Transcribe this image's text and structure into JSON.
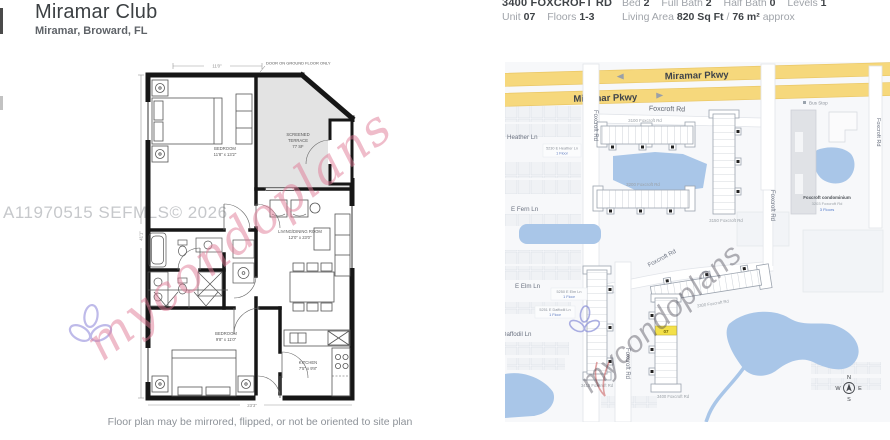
{
  "header": {
    "title": "Miramar Club",
    "subtitle": "Miramar, Broward, FL",
    "address": "3400 FOXCROFT RD",
    "unit_label": "Unit",
    "unit_value": "07",
    "floors_label": "Floors",
    "floors_value": "1-3",
    "bed_label": "Bed",
    "bed_value": "2",
    "full_bath_label": "Full Bath",
    "full_bath_value": "2",
    "half_bath_label": "Half Bath",
    "half_bath_value": "0",
    "levels_label": "Levels",
    "levels_value": "1",
    "living_label": "Living Area",
    "living_value": "820 Sq Ft",
    "living_sep": "/",
    "living_m2": "76 m²",
    "living_approx": "approx"
  },
  "floorplan": {
    "watermark_mls": "A11970515  SEFMLS© 2026",
    "watermark_brand": "mycondoplans",
    "caption": "Floor plan may be mirrored, flipped, or not be oriented to site plan",
    "door_note": "DOOR ON GROUND FLOOR ONLY",
    "dim_top": "11'0\"",
    "dim_left": "41'1\"",
    "dim_bottom": "23'3\"",
    "rooms": {
      "bedroom1_name": "BEDROOM",
      "bedroom1_size": "11'8\" x 13'2\"",
      "terrace_name": "SCREENED",
      "terrace_name2": "TERRACE",
      "terrace_size": "77 SF",
      "living_name": "LIVING/DINING ROOM",
      "living_size": "12'0\" x 23'0\"",
      "bedroom2_name": "BEDROOM",
      "bedroom2_size": "9'8\" x 11'0\"",
      "kitchen_name": "KITCHEN",
      "kitchen_size": "7'5\" x 9'8\""
    }
  },
  "map": {
    "watermark_brand": "mycondoplans",
    "pkwy": "Miramar Pkwy",
    "foxcroft": "Foxcroft Rd",
    "bus_stop": "Bus Stop",
    "buildings": {
      "b3100": "3100 Foxcroft Rd",
      "b3150": "3150 Foxcroft Rd",
      "b3200": "3200 Foxcroft Rd",
      "b3300": "3300 Foxcroft Rd",
      "b3400": "3400 Foxcroft Rd",
      "b3410": "3410 Foxcroft Rd"
    },
    "streets": {
      "heather": "Heather Ln",
      "fern": "E Fern Ln",
      "elm": "E Elm Ln",
      "daffodil": "Daffodil Ln"
    },
    "sublabels": {
      "heather1": "5230 E Heather Ln",
      "heather2": "1 Floor",
      "elm1": "5250 E Elm Ln",
      "elm2": "1 Floor",
      "daffodil1": "5251 E Daffodil Ln",
      "daffodil2": "1 Floor"
    },
    "condo": {
      "name": "Foxcroft condominium",
      "addr": "3203 Foxcroft Rd",
      "floors": "3 Floors"
    },
    "highlight_unit": "07",
    "compass": {
      "n": "N",
      "e": "E",
      "s": "S",
      "w": "W"
    },
    "colors": {
      "road_major": "#f6d87c",
      "water": "#a9c6e8",
      "highlight": "#f3e049"
    }
  }
}
